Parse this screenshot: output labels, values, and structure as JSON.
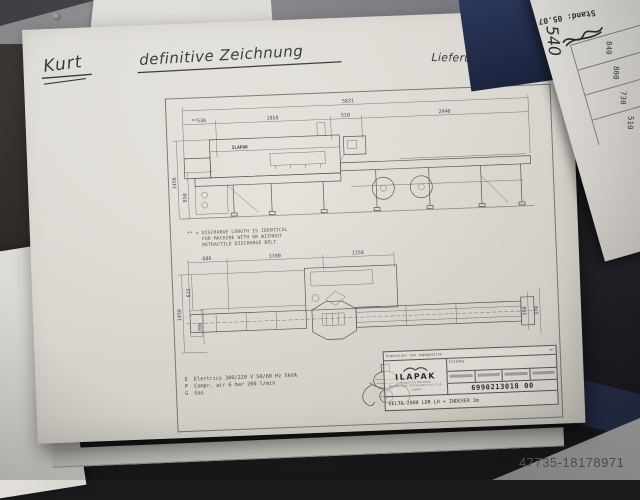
{
  "photo": {
    "watermark": "47735-18178971"
  },
  "desk_note": {
    "heading": "Stand: 05.07",
    "handwritten_value": "540",
    "values": [
      "840",
      "800",
      "730",
      "510"
    ]
  },
  "handwriting": {
    "left": "Kurt",
    "center": "definitive Zeichnung",
    "right": "Lieferung ende KW 29"
  },
  "drawing": {
    "machine_logo": "ILAPAK",
    "side_view": {
      "total_length": "5831",
      "seg_infeed": "**536",
      "seg_body": "1858",
      "seg_mid": "510",
      "seg_discharge": "2940",
      "height_total": "1456",
      "height_belt": "850"
    },
    "note": {
      "line1": "** = DISCHARGE LENGTH IS IDENTICAL",
      "line2": "     FOR MACHINE WITH OR WITHOUT",
      "line3": "     RETRACTILE DISCHARGE BELT"
    },
    "plan_view": {
      "seg_a": "686",
      "seg_b": "1700",
      "seg_c": "1258",
      "width_total": "1450",
      "width_a": "615",
      "width_b": "700",
      "belt_width": "350",
      "belt_frame": "370"
    },
    "utilities": {
      "line1": "E  Electrics 380/220 V 50/60 Hz 5kVA",
      "line2": "P  Compr. air 6 bar 200 l/min",
      "line3": "G  Gas"
    },
    "title_block": {
      "header_note": "Dimensioni non impegnative",
      "brand": "ILAPAK",
      "brand_sub1": "Industria Macchine",
      "brand_sub2": "Automatiche Confezionatrici S.A.",
      "brand_sub3": "Lugano",
      "client_label": "Cliente",
      "description": "DELTA 2000 LDR  LH + INDEXER 3m",
      "drawing_number": "6990213018 00"
    }
  }
}
